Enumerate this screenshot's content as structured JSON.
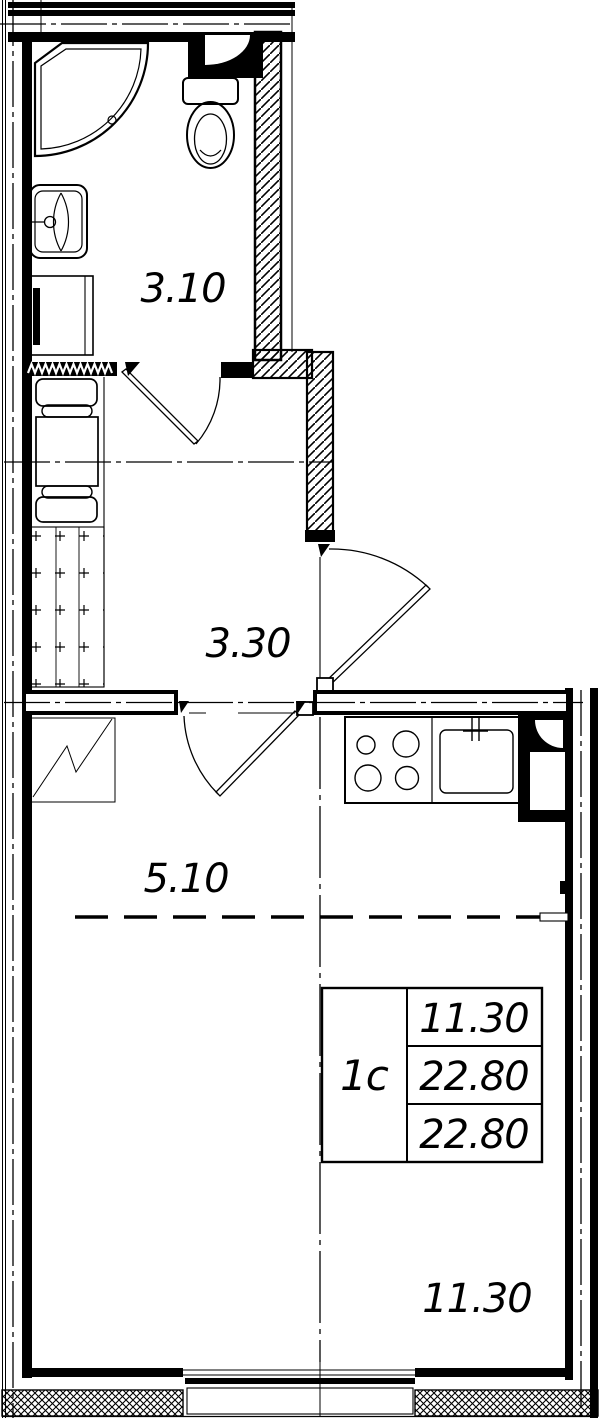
{
  "plan": {
    "rooms": [
      {
        "name": "bathroom",
        "area_label": "3.10"
      },
      {
        "name": "hallway",
        "area_label": "3.30"
      },
      {
        "name": "kitchen-living",
        "area_label": "5.10"
      },
      {
        "name": "living-room",
        "area_label": "11.30"
      }
    ],
    "info_table": {
      "apartment_type": "1c",
      "values": [
        "11.30",
        "22.80",
        "22.80"
      ]
    },
    "colors": {
      "line": "#000000",
      "background": "#ffffff"
    }
  }
}
